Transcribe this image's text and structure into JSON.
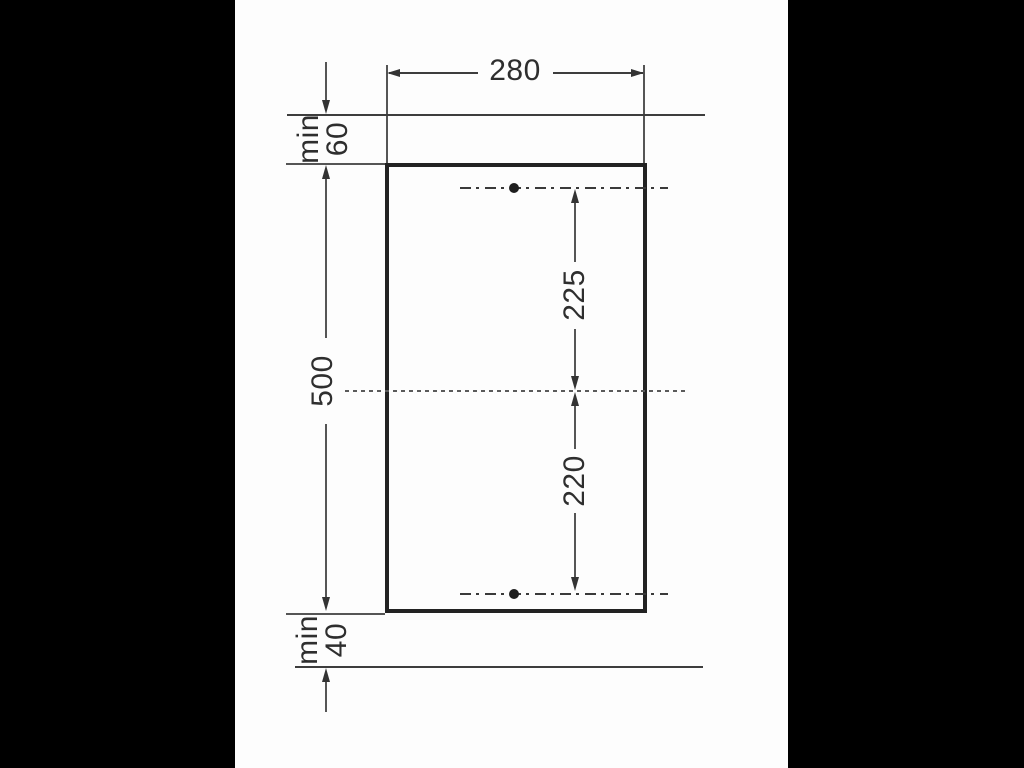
{
  "diagram": {
    "type": "installation-cutout-dimension-drawing",
    "dimensions": {
      "width": {
        "value": "280"
      },
      "height": {
        "value": "500"
      },
      "upper_hole_to_center": {
        "value": "225"
      },
      "center_to_lower_hole": {
        "value": "220"
      },
      "top_clearance": {
        "qualifier": "min",
        "value": "60"
      },
      "bottom_clearance": {
        "qualifier": "min",
        "value": "40"
      }
    },
    "features": {
      "mounting_holes": 2,
      "hole_axis_lines": "dash-dot",
      "center_axis_line": "dashed"
    },
    "colors": {
      "letterbox": "#000000",
      "canvas": "#fdfdfd",
      "outline": "#222222",
      "thin_line": "#555555",
      "text": "#2e2e2e"
    }
  }
}
